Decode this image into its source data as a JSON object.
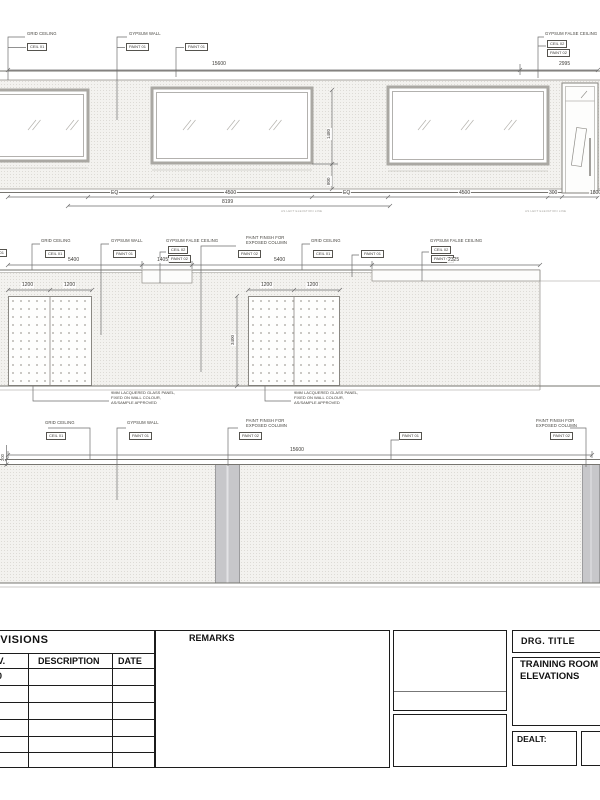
{
  "e1": {
    "labels": {
      "grid_ceiling": "GRID CEILING",
      "gypsum_wall": "GYPSUM WALL",
      "gypsum_false_ceiling": "GYPSUM FALSE CEILING"
    },
    "tags": {
      "ceil01": "CEIL 01",
      "paint01": "PAINT 01",
      "ceil02": "CEIL 02",
      "paint02": "PAINT 02"
    },
    "dims": {
      "total": "15600",
      "right_end": "2995",
      "eq": "EQ",
      "bay": "4500",
      "pier": "300",
      "door": "1800",
      "subtotal": "8199",
      "window_height": "1480",
      "sill_height": "800"
    },
    "caption": "AS LEFT ELEVATION LINE"
  },
  "e2": {
    "labels": {
      "paint_finish_line1": "PAINT FINISH FOR",
      "paint_finish_line2": "EXPOSED COLUMN"
    },
    "dims": {
      "bay1": "5400",
      "recess": "1405",
      "bay2": "5400",
      "bay3": "2325",
      "panel_w": "1200",
      "panel_h": "3400"
    },
    "note": {
      "l1": "9MM LACQUERED GLASS PANEL,",
      "l2": "FIXED ON WALL COLOUR,",
      "l3": "AS/SAMPLE APPROVED"
    }
  },
  "e3": {
    "dims": {
      "total": "15600",
      "ceiling_band": "200"
    }
  },
  "titleblock": {
    "revisions": "REVISIONS",
    "rev_col": "REV.",
    "description_col": "DESCRIPTION",
    "date_col": "DATE",
    "rev_zero": "0",
    "remarks": "REMARKS",
    "drg_title": "DRG.  TITLE",
    "title_line1": "TRAINING ROOM",
    "title_line2": "ELEVATIONS",
    "dealt": "DEALT:"
  }
}
